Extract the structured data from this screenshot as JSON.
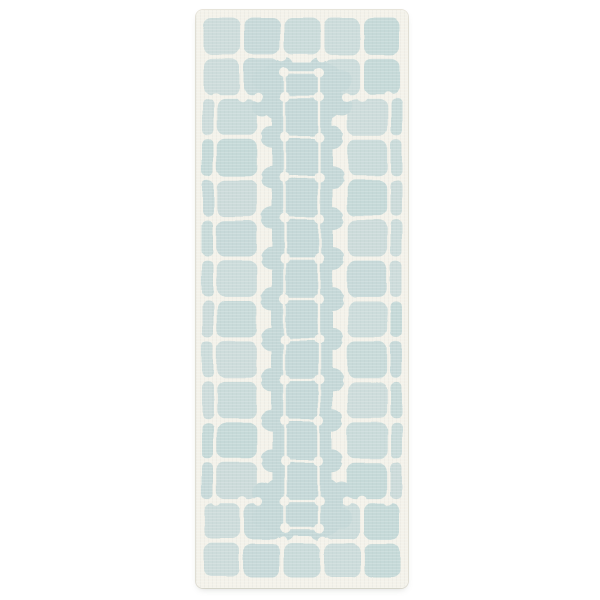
{
  "scene": {
    "background_color": "#ffffff",
    "description": "Product photo of a vertical runner rug: pale aqua rounded square tiles on an ivory ground with white dotted grid lines, a tile border, and a scalloped center medallion band"
  },
  "rug": {
    "left_px": 196,
    "top_px": 10,
    "width_px": 212,
    "height_px": 578,
    "corner_radius_px": 7,
    "colors": {
      "ground_ivory": "#f4f2ea",
      "tile_aqua": "#c5d8d8",
      "grid_ivory": "#f4f2ea",
      "edge_line": "#e9e6dc",
      "drop_shadow": "rgba(105,110,100,0.28)"
    },
    "pattern": {
      "full_columns": 5,
      "row_count": 14,
      "margin_px": 6,
      "side_border": "edge strip plus one tile column per side",
      "center_band_scallops_per_side": 11,
      "center_band_dot_rows": 13
    }
  }
}
